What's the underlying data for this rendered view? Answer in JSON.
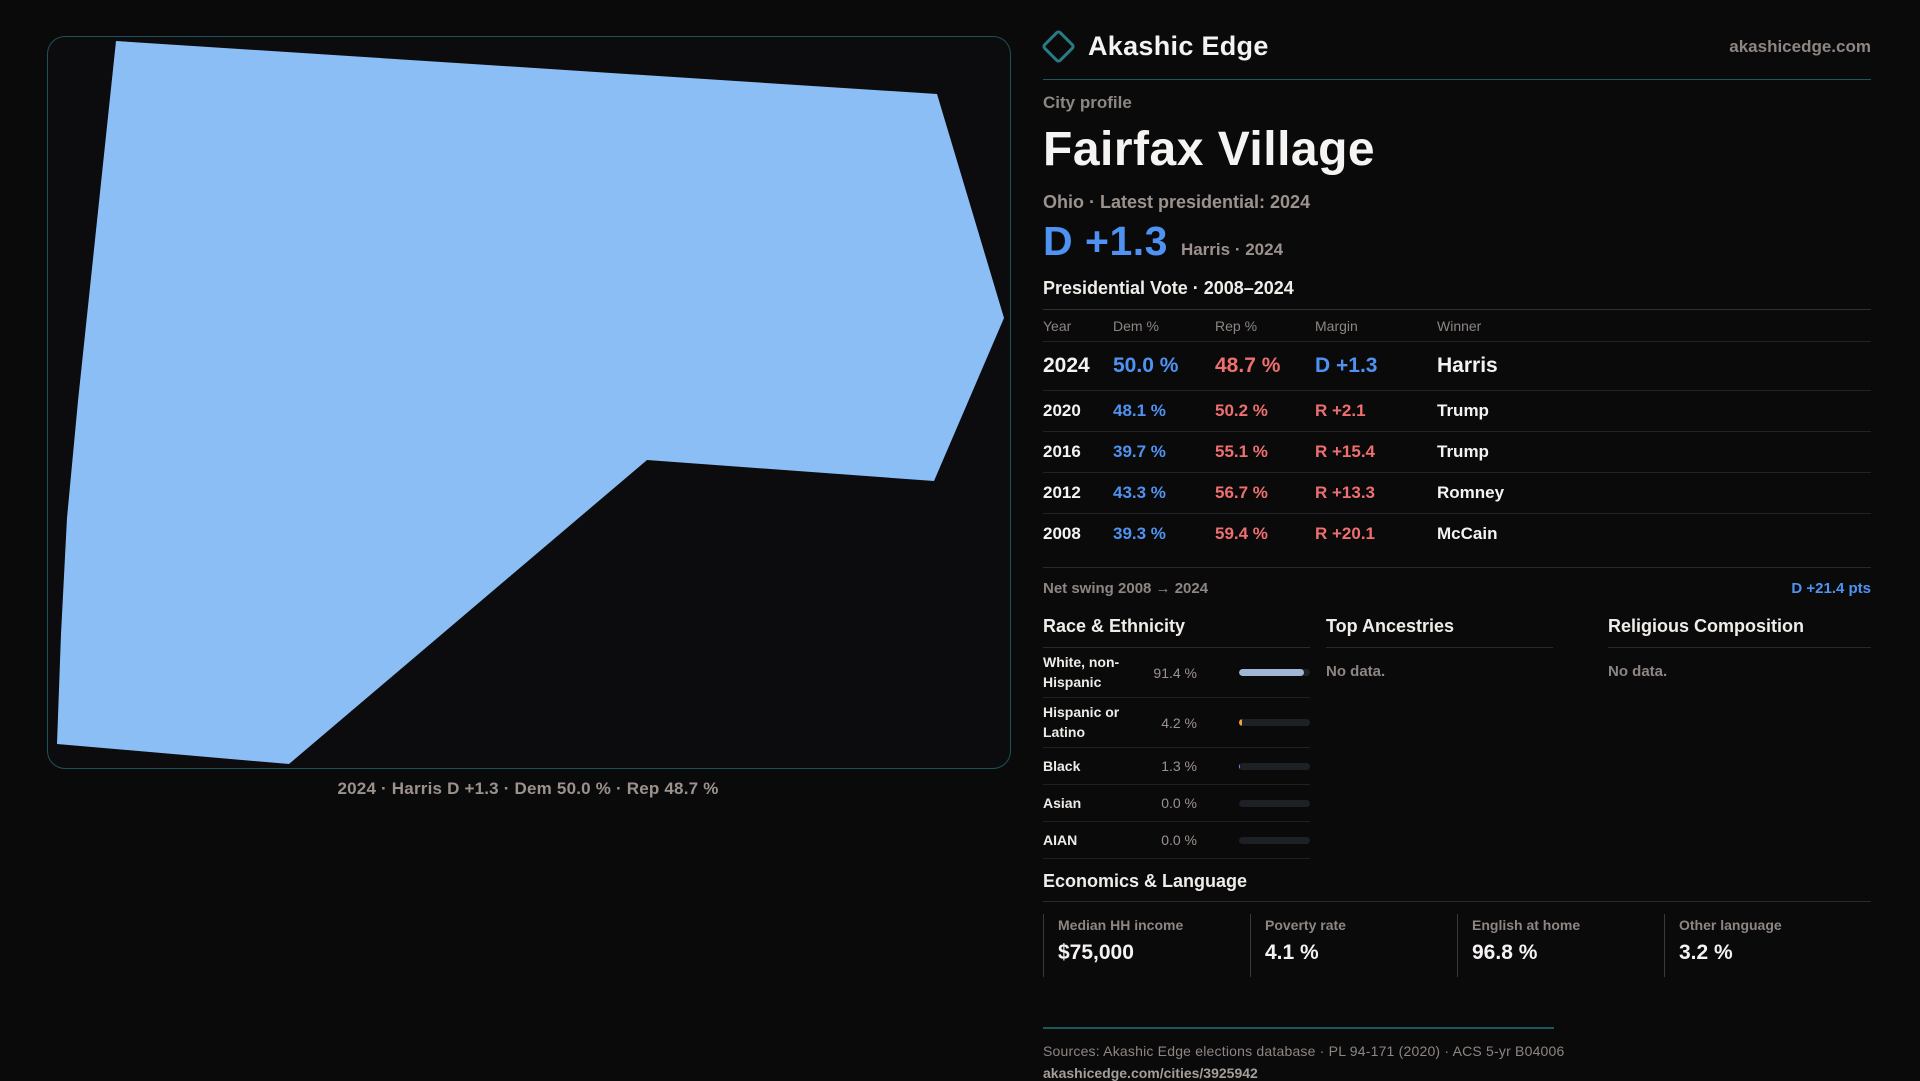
{
  "brand": {
    "name": "Akashic Edge",
    "domain": "akashicedge.com"
  },
  "profile": {
    "kicker": "City profile",
    "title": "Fairfax Village",
    "subtitle": "Ohio · Latest presidential: 2024",
    "lead_margin": "D +1.3",
    "lead_context": "Harris · 2024"
  },
  "map": {
    "caption": "2024 · Harris D +1.3 · Dem 50.0 % · Rep 48.7 %",
    "shape_fill": "#8cbef6",
    "polygon": "68,4 889,57 956,281 886,444 599,423 241,727 9,707 13,597 19,481 30,364"
  },
  "vote_table": {
    "title": "Presidential Vote · 2008–2024",
    "columns": [
      "Year",
      "Dem %",
      "Rep %",
      "Margin",
      "Winner"
    ],
    "rows": [
      {
        "year": "2024",
        "dem": "50.0 %",
        "rep": "48.7 %",
        "margin": "D +1.3",
        "margin_party": "D",
        "winner": "Harris"
      },
      {
        "year": "2020",
        "dem": "48.1 %",
        "rep": "50.2 %",
        "margin": "R +2.1",
        "margin_party": "R",
        "winner": "Trump"
      },
      {
        "year": "2016",
        "dem": "39.7 %",
        "rep": "55.1 %",
        "margin": "R +15.4",
        "margin_party": "R",
        "winner": "Trump"
      },
      {
        "year": "2012",
        "dem": "43.3 %",
        "rep": "56.7 %",
        "margin": "R +13.3",
        "margin_party": "R",
        "winner": "Romney"
      },
      {
        "year": "2008",
        "dem": "39.3 %",
        "rep": "59.4 %",
        "margin": "R +20.1",
        "margin_party": "R",
        "winner": "McCain"
      }
    ]
  },
  "net_swing": {
    "label": "Net swing 2008 → 2024",
    "value": "D +21.4 pts"
  },
  "race": {
    "title": "Race & Ethnicity",
    "rows": [
      {
        "label": "White, non-Hispanic",
        "value": "91.4 %",
        "pct": 91.4,
        "bar_color": "#9fb6d4"
      },
      {
        "label": "Hispanic or Latino",
        "value": "4.2 %",
        "pct": 4.2,
        "bar_color": "#f2a33a"
      },
      {
        "label": "Black",
        "value": "1.3 %",
        "pct": 1.3,
        "bar_color": "#8388f2"
      },
      {
        "label": "Asian",
        "value": "0.0 %",
        "pct": 0,
        "bar_color": "#9fb6d4"
      },
      {
        "label": "AIAN",
        "value": "0.0 %",
        "pct": 0,
        "bar_color": "#9fb6d4"
      }
    ]
  },
  "ancestries": {
    "title": "Top Ancestries",
    "empty": "No data."
  },
  "religion": {
    "title": "Religious Composition",
    "empty": "No data."
  },
  "economics": {
    "title": "Economics & Language",
    "cards": [
      {
        "label": "Median HH income",
        "value": "$75,000"
      },
      {
        "label": "Poverty rate",
        "value": "4.1 %"
      },
      {
        "label": "English at home",
        "value": "96.8 %"
      },
      {
        "label": "Other language",
        "value": "3.2 %"
      }
    ]
  },
  "footer": {
    "sources": "Sources: Akashic Edge elections database · PL 94-171 (2020) · ACS 5-yr B04006",
    "permalink": "akashicedge.com/cities/3925942"
  },
  "colors": {
    "dem_blue": "#4f93f2",
    "rep_red": "#ee6f6f",
    "accent_teal": "#1e565e",
    "map_fill": "#8cbef6"
  }
}
